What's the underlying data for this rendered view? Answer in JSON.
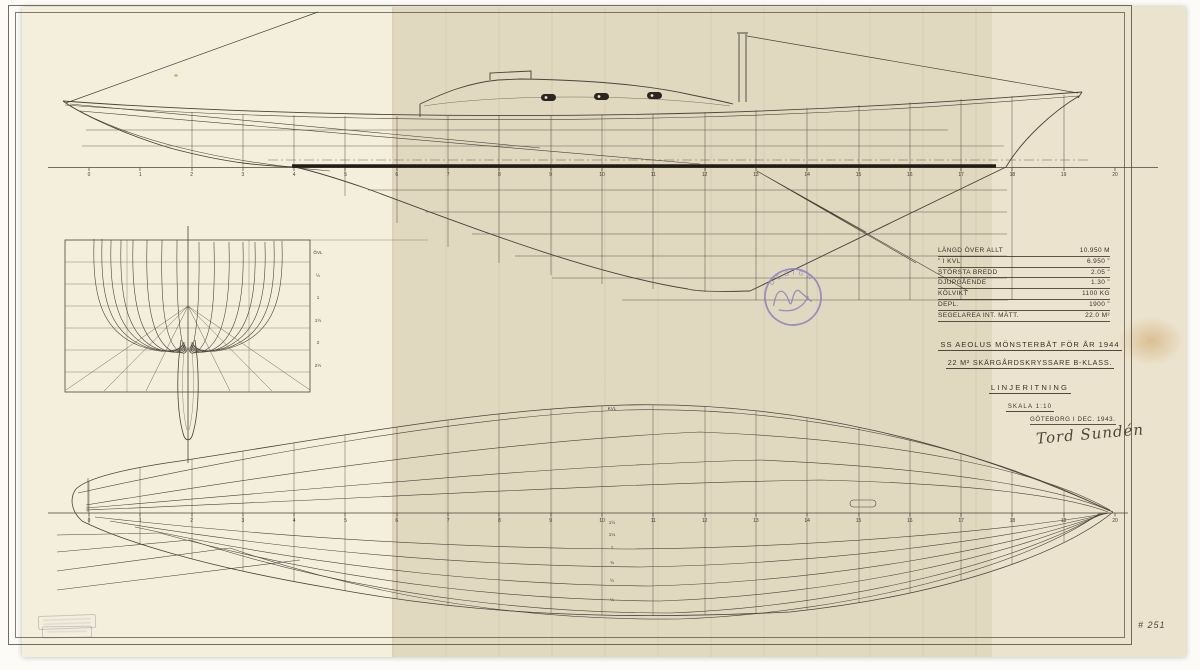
{
  "title_block": {
    "line1": "SS AEOLUS  MÖNSTERBÅT FÖR ÅR 1944",
    "line2": "22 M² SKÄRGÅRDSKRYSSARE  B-KLASS.",
    "line3": "LINJERITNING",
    "line4": "SKALA 1:10",
    "place_date": "GÖTEBORG I DEC. 1943.",
    "signature": "Tord Sundén"
  },
  "dimensions_table": {
    "rows": [
      {
        "label": "LÄNGD ÖVER ALLT",
        "value": "10.950 M"
      },
      {
        "label": "”    I KVL",
        "value": "6.950 ”"
      },
      {
        "label": "STÖRSTA BREDD",
        "value": "2.05 ”"
      },
      {
        "label": "DJUPGÅENDE",
        "value": "1.30 ”"
      },
      {
        "label": "KÖLVIKT",
        "value": "1100 KG"
      },
      {
        "label": "DEPL.",
        "value": "1900 ”"
      },
      {
        "label": "SEGELAREA INT. MÄTT.",
        "value": "22.0 M²"
      }
    ]
  },
  "stamp": {
    "arc_text": "DESIGN"
  },
  "sheet_number": "# 251",
  "axes": {
    "stations": [
      "0",
      "1",
      "2",
      "3",
      "4",
      "5",
      "6",
      "7",
      "8",
      "9",
      "10",
      "11",
      "12",
      "13",
      "14",
      "15",
      "16",
      "17",
      "18",
      "19",
      "20"
    ]
  },
  "labels": {
    "plan_waterlines": [
      "KVL",
      "1½",
      "1¼",
      "1",
      "¾",
      "½",
      "¼"
    ],
    "body_plan_waterlines": [
      "ÖVL",
      "½",
      "1",
      "1½",
      "2",
      "2½"
    ]
  },
  "colors": {
    "paper": "#ece3ce",
    "ink": "#4a4339",
    "ink_heavy": "#211c15",
    "stamp": "#8a7cbd"
  }
}
